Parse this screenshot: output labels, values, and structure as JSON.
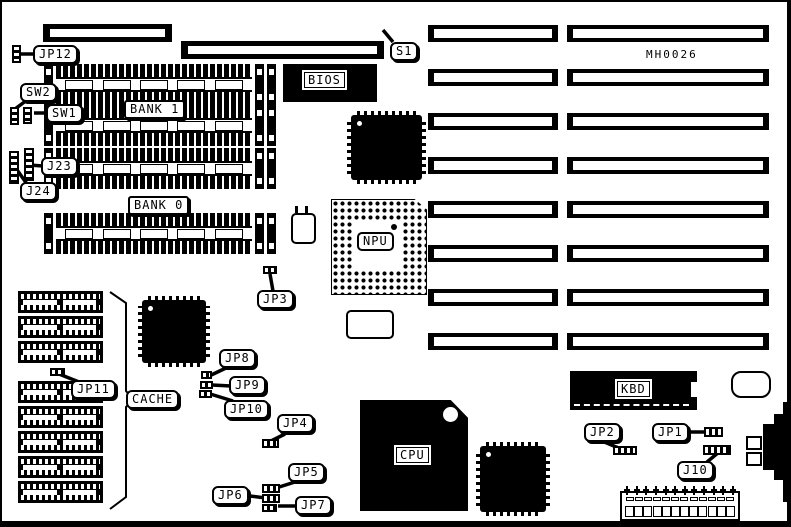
{
  "diagram": {
    "part_number": "MH0026",
    "labels": {
      "jp12": "JP12",
      "s1": "S1",
      "sw2": "SW2",
      "sw1": "SW1",
      "j23": "J23",
      "j24": "J24",
      "bank1": "BANK 1",
      "bank0": "BANK 0",
      "bios": "BIOS",
      "npu": "NPU",
      "jp3": "JP3",
      "jp11": "JP11",
      "cache": "CACHE",
      "jp8": "JP8",
      "jp9": "JP9",
      "jp10": "JP10",
      "jp4": "JP4",
      "jp5": "JP5",
      "jp6": "JP6",
      "jp7": "JP7",
      "cpu": "CPU",
      "kbd": "KBD",
      "jp2": "JP2",
      "jp1": "JP1",
      "j10": "J10"
    }
  }
}
